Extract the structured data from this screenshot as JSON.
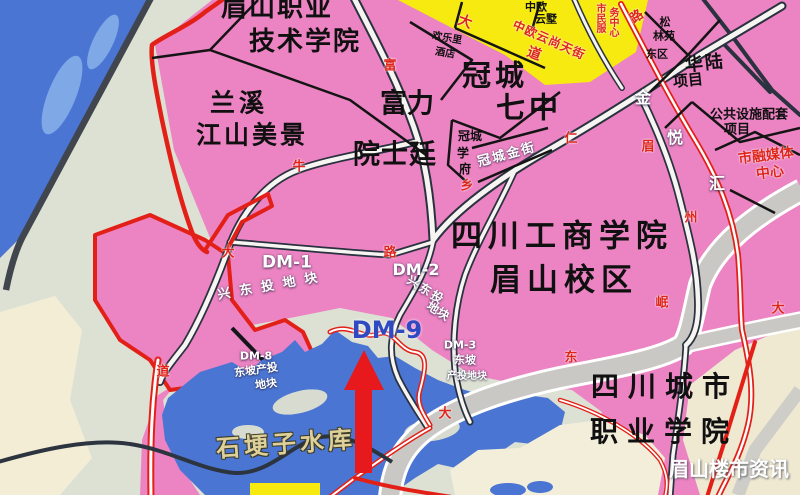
{
  "map_title": "眉山岷东新区规划示意图",
  "watermark": "眉山楼市资讯",
  "colors": {
    "land_pink": "#ec83c3",
    "land_gray": "#dde1d4",
    "land_cream": "#f3edd6",
    "water_blue": "#4a75d3",
    "water_light": "#7ea8e6",
    "block_yellow": "#f6ea10",
    "road_fill": "#f7f5f1",
    "road_casing": "#2a3240",
    "avenue_gray": "#c9c8c4",
    "planned_red": "#e32017",
    "dm9_blue": "#2f49c3",
    "lake_label_tan": "#ddd09a"
  },
  "labels": [
    {
      "id": "label-meishan-vocational-1",
      "text": "眉山职业",
      "x": 277,
      "y": 8,
      "fs": 26,
      "ls": 2,
      "cls": "black"
    },
    {
      "id": "label-meishan-vocational-2",
      "text": "技术学院",
      "x": 305,
      "y": 42,
      "fs": 26,
      "ls": 2,
      "cls": "black"
    },
    {
      "id": "label-lanxi-1",
      "text": "兰溪",
      "x": 239,
      "y": 103,
      "fs": 25,
      "ls": 4,
      "cls": "black"
    },
    {
      "id": "label-lanxi-2",
      "text": "江山美景",
      "x": 252,
      "y": 135,
      "fs": 25,
      "ls": 3,
      "cls": "black"
    },
    {
      "id": "label-fuli-1",
      "text": "富力",
      "x": 407,
      "y": 104,
      "fs": 27,
      "cls": "black"
    },
    {
      "id": "label-fuli-2",
      "text": "院士廷",
      "x": 395,
      "y": 155,
      "fs": 27,
      "ls": 1,
      "cls": "black"
    },
    {
      "id": "label-guancheng-7-1",
      "text": "冠城",
      "x": 495,
      "y": 76,
      "fs": 29,
      "ls": 4,
      "cls": "black"
    },
    {
      "id": "label-guancheng-7-2",
      "text": "七中",
      "x": 529,
      "y": 108,
      "fs": 29,
      "ls": 4,
      "cls": "black"
    },
    {
      "id": "label-gongshang-1",
      "text": "四川工商学院",
      "x": 562,
      "y": 237,
      "fs": 31,
      "ls": 6,
      "cls": "black"
    },
    {
      "id": "label-gongshang-2",
      "text": "眉山校区",
      "x": 564,
      "y": 281,
      "fs": 31,
      "ls": 6,
      "cls": "black"
    },
    {
      "id": "label-chengshi-1",
      "text": "四川城市",
      "x": 665,
      "y": 387,
      "fs": 28,
      "ls": 9,
      "cls": "black"
    },
    {
      "id": "label-chengshi-2",
      "text": "职业学院",
      "x": 664,
      "y": 432,
      "fs": 28,
      "ls": 9,
      "cls": "black"
    },
    {
      "id": "label-zhongou-yunshu-1",
      "text": "中欧",
      "x": 536,
      "y": 7,
      "fs": 11,
      "cls": "black"
    },
    {
      "id": "label-zhongou-yunshu-2",
      "text": "云墅",
      "x": 546,
      "y": 19,
      "fs": 11,
      "cls": "black"
    },
    {
      "id": "label-huanleli-1",
      "text": "欢乐里",
      "x": 447,
      "y": 39,
      "fs": 10,
      "rot": 10,
      "cls": "black"
    },
    {
      "id": "label-huanleli-2",
      "text": "酒店",
      "x": 445,
      "y": 54,
      "fs": 10,
      "rot": 10,
      "cls": "black"
    },
    {
      "id": "label-guancheng-xuefu-1",
      "text": "冠城",
      "x": 470,
      "y": 136,
      "fs": 12,
      "cls": "black"
    },
    {
      "id": "label-guancheng-xuefu-2",
      "text": "学",
      "x": 463,
      "y": 153,
      "fs": 12,
      "cls": "black"
    },
    {
      "id": "label-guancheng-xuefu-3",
      "text": "府",
      "x": 465,
      "y": 169,
      "fs": 12,
      "cls": "black"
    },
    {
      "id": "label-guancheng-jinjie",
      "text": "冠城金街",
      "x": 507,
      "y": 155,
      "fs": 13,
      "rot": -15,
      "ls": 2,
      "cls": "white"
    },
    {
      "id": "label-songlinyuan-1",
      "text": "松",
      "x": 665,
      "y": 22,
      "fs": 11,
      "cls": "black"
    },
    {
      "id": "label-songlinyuan-2",
      "text": "林苑",
      "x": 664,
      "y": 36,
      "fs": 11,
      "cls": "black"
    },
    {
      "id": "label-songlinyuan-3",
      "text": "东区",
      "x": 657,
      "y": 54,
      "fs": 11,
      "cls": "black"
    },
    {
      "id": "label-hualu-1",
      "text": "华陆",
      "x": 705,
      "y": 64,
      "fs": 18,
      "rot": -6,
      "ls": 2,
      "cls": "black"
    },
    {
      "id": "label-hualu-2",
      "text": "项目",
      "x": 688,
      "y": 81,
      "fs": 15,
      "rot": -6,
      "cls": "black"
    },
    {
      "id": "label-gongshe-1",
      "text": "公共设施配套",
      "x": 749,
      "y": 115,
      "fs": 13,
      "cls": "black"
    },
    {
      "id": "label-gongshe-2",
      "text": "项目",
      "x": 737,
      "y": 130,
      "fs": 13,
      "cls": "black"
    },
    {
      "id": "label-rongmeiti-1",
      "text": "市融媒体",
      "x": 766,
      "y": 156,
      "fs": 14,
      "rot": -7,
      "cls": "red"
    },
    {
      "id": "label-rongmeiti-2",
      "text": "中心",
      "x": 770,
      "y": 173,
      "fs": 14,
      "rot": -7,
      "cls": "red"
    },
    {
      "id": "label-shimin-fuwu-1",
      "text": "市民服",
      "x": 599,
      "y": 18,
      "fs": 10,
      "vert": true,
      "cls": "red"
    },
    {
      "id": "label-shimin-fuwu-2",
      "text": "务中心",
      "x": 612,
      "y": 22,
      "fs": 10,
      "vert": true,
      "cls": "red"
    },
    {
      "id": "label-dm1",
      "text": "DM-1",
      "x": 287,
      "y": 263,
      "fs": 17,
      "cls": "white"
    },
    {
      "id": "label-dm1-parcel",
      "text": "兴东投地块",
      "x": 272,
      "y": 286,
      "fs": 13,
      "rot": -10,
      "ls": 9,
      "cls": "white"
    },
    {
      "id": "label-dm2",
      "text": "DM-2",
      "x": 416,
      "y": 270,
      "fs": 16,
      "cls": "white"
    },
    {
      "id": "label-dm2-parcel-1",
      "text": "兴东投",
      "x": 426,
      "y": 290,
      "fs": 12,
      "rot": 32,
      "ls": 2,
      "cls": "white"
    },
    {
      "id": "label-dm2-parcel-2",
      "text": "地块",
      "x": 438,
      "y": 311,
      "fs": 12,
      "rot": 32,
      "cls": "white"
    },
    {
      "id": "label-dm9",
      "text": "DM-9",
      "x": 387,
      "y": 330,
      "fs": 24,
      "cls": "blue"
    },
    {
      "id": "label-dm8",
      "text": "DM-8",
      "x": 256,
      "y": 356,
      "fs": 11,
      "cls": "white"
    },
    {
      "id": "label-dm8-parcel-1",
      "text": "东坡产投",
      "x": 256,
      "y": 370,
      "fs": 11,
      "rot": -8,
      "cls": "white"
    },
    {
      "id": "label-dm8-parcel-2",
      "text": "地块",
      "x": 266,
      "y": 384,
      "fs": 11,
      "rot": -8,
      "cls": "white"
    },
    {
      "id": "label-dm3",
      "text": "DM-3",
      "x": 460,
      "y": 345,
      "fs": 11,
      "cls": "white"
    },
    {
      "id": "label-dm3-parcel-1",
      "text": "东坡",
      "x": 465,
      "y": 360,
      "fs": 11,
      "cls": "white"
    },
    {
      "id": "label-dm3-parcel-2",
      "text": "产投地块",
      "x": 467,
      "y": 377,
      "fs": 10,
      "cls": "white"
    },
    {
      "id": "label-reservoir",
      "text": "石埂子水库",
      "x": 286,
      "y": 444,
      "fs": 24,
      "rot": -4,
      "ls": 4,
      "cls": "tan"
    },
    {
      "id": "label-watermark",
      "text": "眉山楼市资讯",
      "x": 729,
      "y": 469,
      "fs": 20,
      "cls": "wm"
    },
    {
      "id": "roadchar-da-north",
      "text": "大",
      "x": 465,
      "y": 22,
      "fs": 14,
      "rot": 20,
      "cls": "red"
    },
    {
      "id": "roadchar-dao-north",
      "text": "道",
      "x": 534,
      "y": 54,
      "fs": 14,
      "rot": 20,
      "cls": "red"
    },
    {
      "id": "label-zhongou-tianjie",
      "text": "中欧云尚天街",
      "x": 549,
      "y": 40,
      "fs": 12,
      "rot": 24,
      "ls": 1,
      "cls": "red"
    },
    {
      "id": "roadchar-lu-topright",
      "text": "路",
      "x": 637,
      "y": 17,
      "fs": 13,
      "rot": -35,
      "cls": "red"
    },
    {
      "id": "roadchar-fu",
      "text": "富",
      "x": 390,
      "y": 66,
      "fs": 13,
      "cls": "red"
    },
    {
      "id": "roadchar-niu",
      "text": "牛",
      "x": 299,
      "y": 167,
      "fs": 13,
      "cls": "red"
    },
    {
      "id": "roadchar-da-west",
      "text": "大",
      "x": 228,
      "y": 253,
      "fs": 13,
      "cls": "red"
    },
    {
      "id": "roadchar-dao-west",
      "text": "道",
      "x": 163,
      "y": 372,
      "fs": 13,
      "cls": "red"
    },
    {
      "id": "roadchar-ren",
      "text": "仁",
      "x": 571,
      "y": 139,
      "fs": 13,
      "cls": "red"
    },
    {
      "id": "roadchar-xiang",
      "text": "乡",
      "x": 467,
      "y": 186,
      "fs": 13,
      "cls": "red"
    },
    {
      "id": "roadchar-lu-mid",
      "text": "路",
      "x": 390,
      "y": 253,
      "fs": 13,
      "cls": "red"
    },
    {
      "id": "roadchar-mei",
      "text": "眉",
      "x": 648,
      "y": 147,
      "fs": 13,
      "cls": "red"
    },
    {
      "id": "roadchar-zhou",
      "text": "州",
      "x": 691,
      "y": 218,
      "fs": 13,
      "cls": "red"
    },
    {
      "id": "roadchar-da-east",
      "text": "大",
      "x": 778,
      "y": 309,
      "fs": 13,
      "cls": "red"
    },
    {
      "id": "roadchar-min",
      "text": "岷",
      "x": 662,
      "y": 303,
      "fs": 13,
      "cls": "red"
    },
    {
      "id": "roadchar-dong",
      "text": "东",
      "x": 571,
      "y": 358,
      "fs": 13,
      "cls": "red"
    },
    {
      "id": "roadchar-da-south",
      "text": "大",
      "x": 445,
      "y": 414,
      "fs": 13,
      "cls": "red"
    },
    {
      "id": "roadchar-jin",
      "text": "金",
      "x": 643,
      "y": 98,
      "fs": 16,
      "cls": "white"
    },
    {
      "id": "roadchar-yue",
      "text": "悦",
      "x": 675,
      "y": 138,
      "fs": 16,
      "cls": "white"
    },
    {
      "id": "roadchar-hui",
      "text": "汇",
      "x": 717,
      "y": 184,
      "fs": 16,
      "cls": "white"
    }
  ]
}
